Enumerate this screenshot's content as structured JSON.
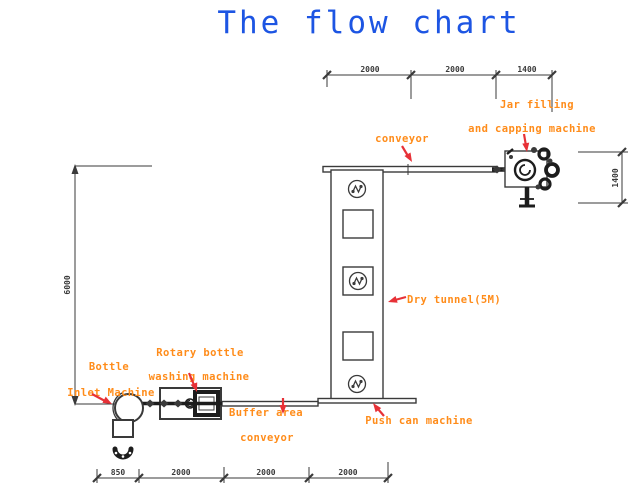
{
  "title": "The flow chart",
  "colors": {
    "title_blue": "#1d55e3",
    "label_orange": "#ff8c1a",
    "arrow_red": "#e73137",
    "line_gray": "#3a3a3a"
  },
  "labels": {
    "conveyor_top": "conveyor",
    "jar_filling_line1": "Jar filling",
    "jar_filling_line2": "and capping machine",
    "dry_tunnel": "Dry tunnel(5M)",
    "push_can_machine": "Push can machine",
    "buffer_area_line1": "Buffer area",
    "buffer_area_line2": "conveyor",
    "rotary_washer_line1": "Rotary bottle",
    "rotary_washer_line2": "washing machine",
    "bottle_inlet_line1": "Bottle",
    "bottle_inlet_line2": "Inlet Machine"
  },
  "dimensions": {
    "top_segments": [
      "2000",
      "2000",
      "1400"
    ],
    "bottom_segments": [
      "850",
      "2000",
      "2000",
      "2000"
    ],
    "left_total_height": "6000",
    "right_machine_height": "1400"
  }
}
